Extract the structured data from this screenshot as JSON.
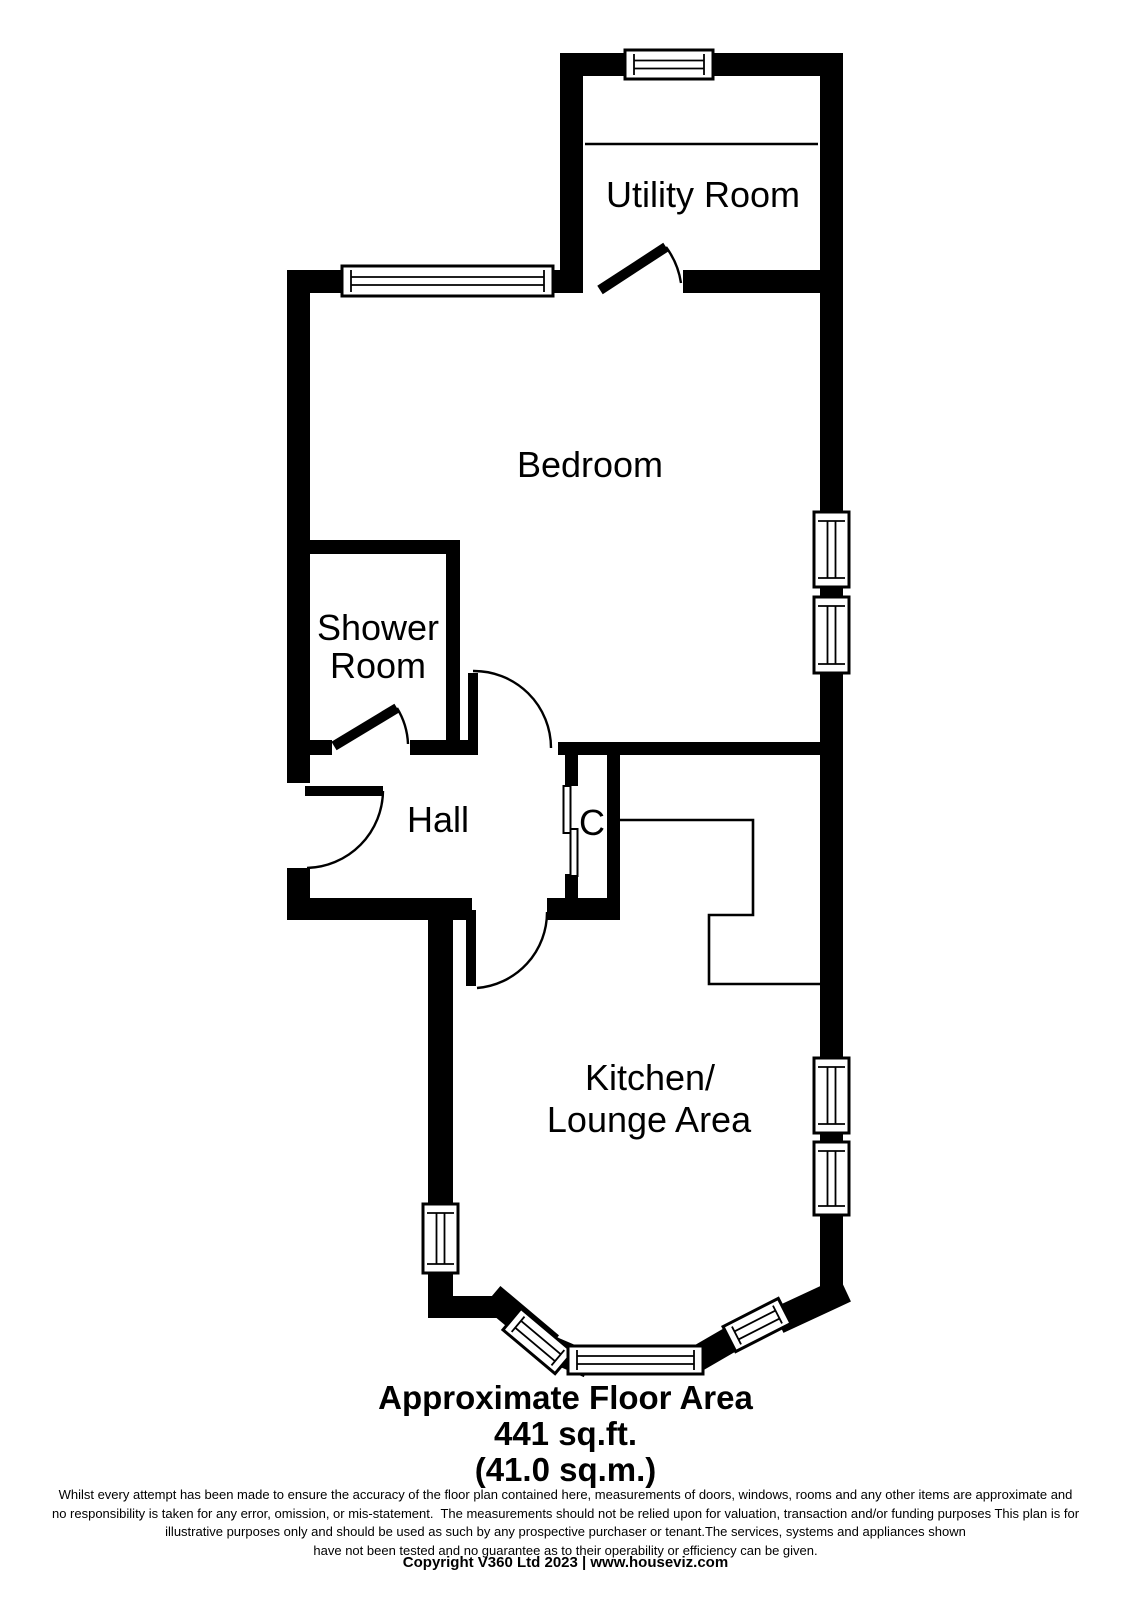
{
  "page": {
    "background": "#ffffff",
    "wall_color": "#000000",
    "floor_color": "#ffffff"
  },
  "floor_plan": {
    "rooms": {
      "utility": {
        "label": "Utility Room"
      },
      "bedroom": {
        "label": "Bedroom"
      },
      "shower": {
        "line1": "Shower",
        "line2": "Room"
      },
      "hall": {
        "label": "Hall"
      },
      "closet": {
        "label": "C"
      },
      "kitchen": {
        "line1": "Kitchen/",
        "line2": "Lounge Area"
      }
    }
  },
  "footer": {
    "area_title": "Approximate Floor Area",
    "area_imperial": "441 sq.ft.",
    "area_metric": "(41.0 sq.m.)",
    "disclaimer_lines": [
      "Whilst every attempt has been made to ensure the accuracy of the floor plan contained here, measurements of doors, windows, rooms and any other items are approximate and",
      "no responsibility is taken for any error, omission, or mis-statement.  The measurements should not be relied upon for valuation, transaction and/or funding purposes This plan is for",
      "illustrative purposes only and should be used as such by any prospective purchaser or tenant.The services, systems and appliances shown",
      "have not been tested and no guarantee as to their operability or efficiency can be given."
    ],
    "copyright": "Copyright V360 Ltd 2023 | www.houseviz.com"
  }
}
